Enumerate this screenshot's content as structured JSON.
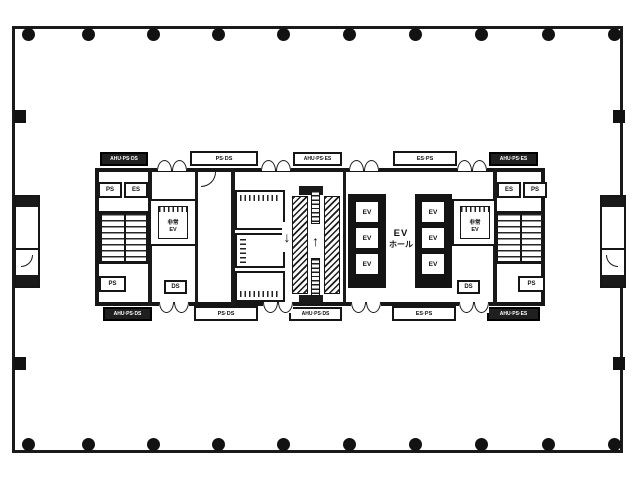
{
  "labels": {
    "top_boxes": [
      "AHU·PS·DS",
      "PS·DS",
      "AHU·PS·ES",
      "ES·PS",
      "AHU·PS·ES"
    ],
    "bottom_boxes": [
      "AHU·PS·DS",
      "PS·DS",
      "AHU·PS·DS",
      "ES·PS",
      "AHU·PS·ES"
    ],
    "left_core": {
      "top_room_1": "PS",
      "top_room_2": "ES",
      "bottom_room": "PS",
      "duct": "DS"
    },
    "right_core": {
      "top_room_1": "ES",
      "top_room_2": "PS",
      "bottom_room": "PS",
      "duct": "DS"
    },
    "emergency_elevator": {
      "line1": "非常",
      "line2": "EV"
    },
    "ev_hall": {
      "line1": "EV",
      "line2": "ホール"
    },
    "ev_car": "EV",
    "escalator_up_arrow": "↑",
    "escalator_down_arrow": "↓"
  },
  "colors": {
    "wall": "#1a1a1a",
    "paper": "#ffffff",
    "label_dark_bg": "#1f1f1f",
    "label_dark_text": "#ffffff"
  }
}
